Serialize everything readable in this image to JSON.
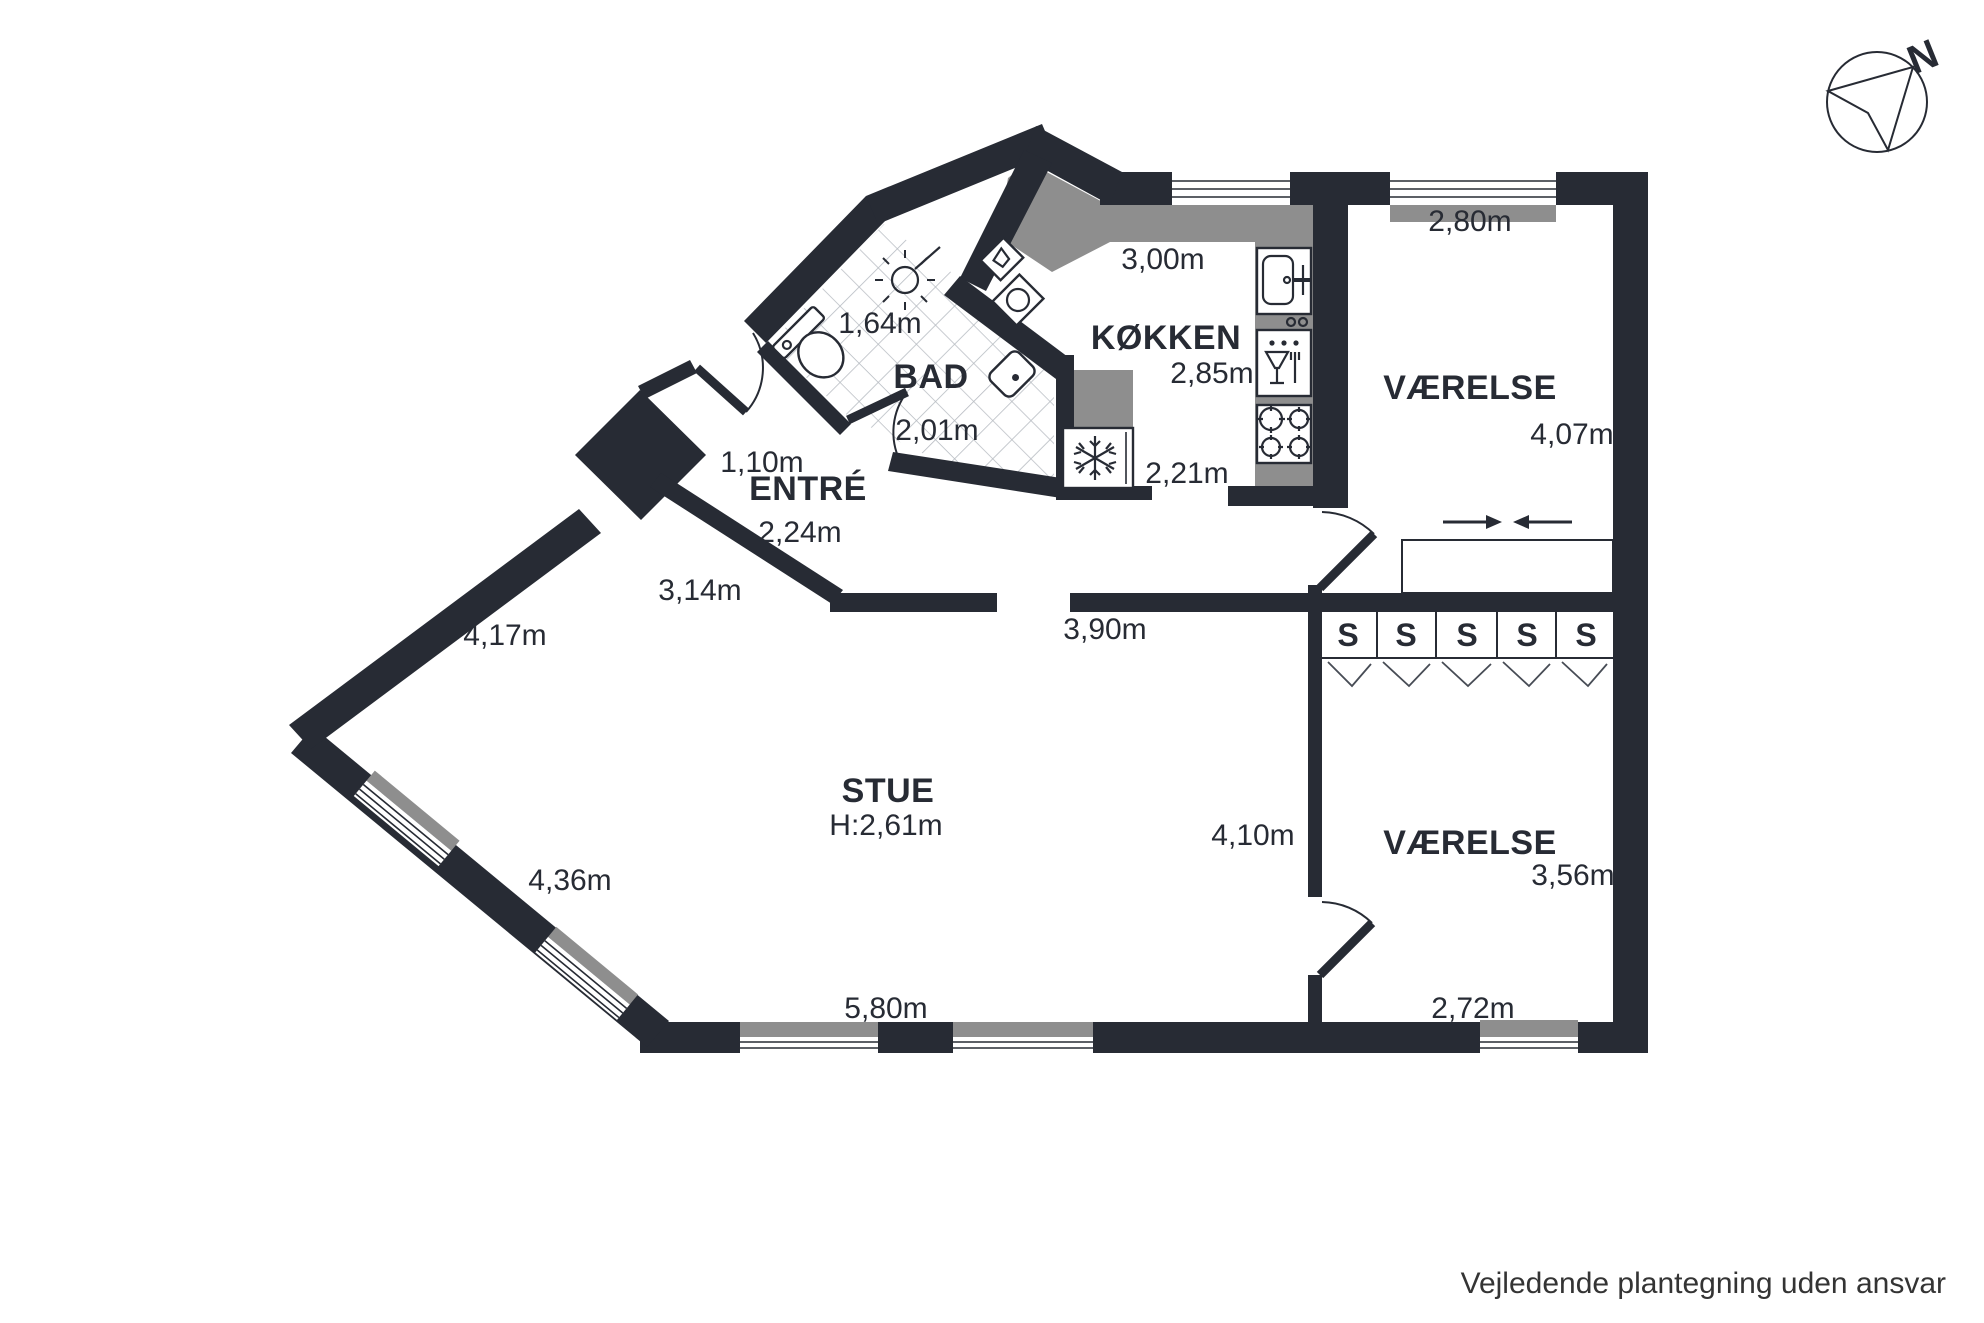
{
  "colors": {
    "wall": "#272b34",
    "counter": "#8e8e8e",
    "tile": "#b7bcc2",
    "paper": "#ffffff"
  },
  "compass": {
    "north": "N"
  },
  "closets": {
    "label": "S"
  },
  "footer": {
    "disclaimer": "Vejledende plantegning uden ansvar"
  },
  "rooms": {
    "bad": {
      "name": "BAD",
      "width": "1,64m",
      "depth": "2,01m"
    },
    "kokken": {
      "name": "KØKKEN",
      "top": "3,00m",
      "right": "2,85m",
      "bottom": "2,21m"
    },
    "entre": {
      "name": "ENTRÉ",
      "door": "1,10m",
      "width": "2,24m",
      "wall": "3,14m"
    },
    "stue": {
      "name": "STUE",
      "ceiling": "H:2,61m",
      "top": "3,90m",
      "upper_left": "4,17m",
      "lower_left": "4,36m",
      "bottom": "5,80m",
      "right": "4,10m"
    },
    "vaerelse_top": {
      "name": "VÆRELSE",
      "top": "2,80m",
      "right": "4,07m"
    },
    "vaerelse_bottom": {
      "name": "VÆRELSE",
      "right": "3,56m",
      "bottom": "2,72m"
    }
  }
}
